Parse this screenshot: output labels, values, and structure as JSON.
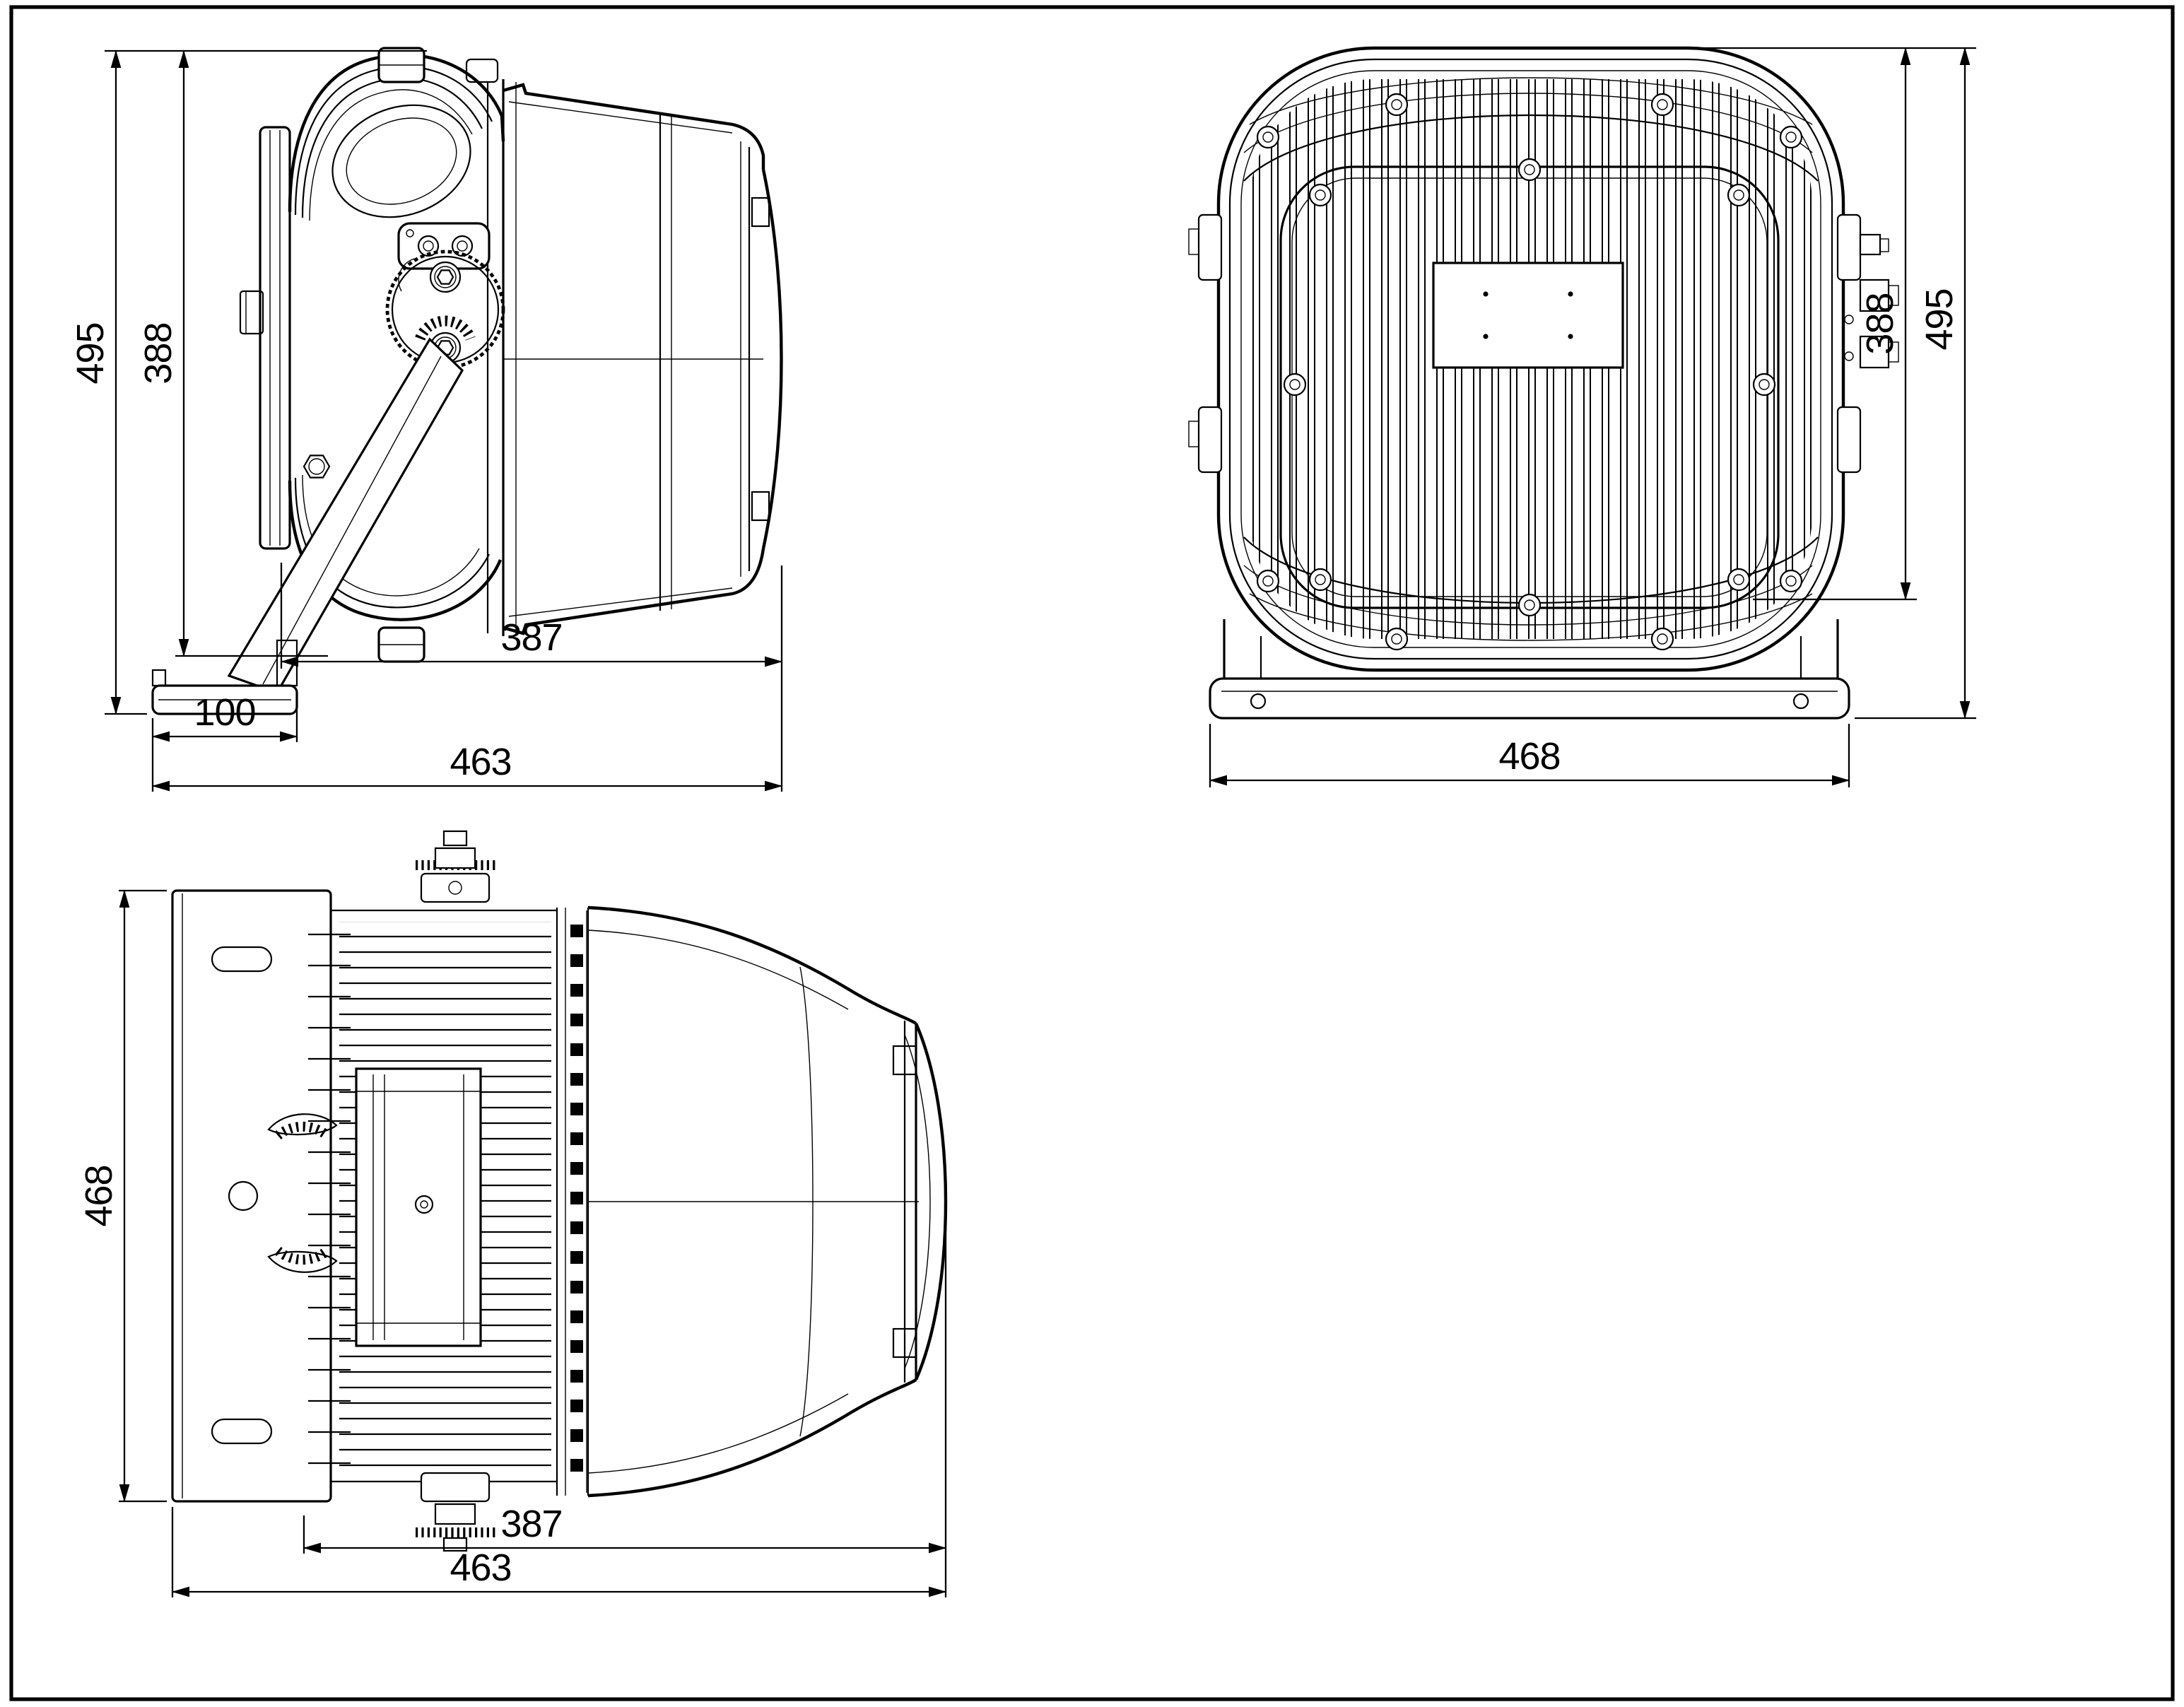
{
  "drawing": {
    "kind": "three-view dimensional line drawing of an LED floodlight luminaire",
    "colors": {
      "ink": "#000000",
      "paper": "#ffffff"
    }
  },
  "views": {
    "side": {
      "dims": {
        "overall_height": "495",
        "body_height": "388",
        "body_length": "387",
        "base_length": "100",
        "overall_length": "463"
      }
    },
    "rear": {
      "dims": {
        "body_height": "388",
        "overall_height": "495",
        "bracket_width": "468"
      }
    },
    "top": {
      "dims": {
        "bracket_plate_height": "468",
        "body_length": "387",
        "overall_length": "463"
      }
    }
  }
}
